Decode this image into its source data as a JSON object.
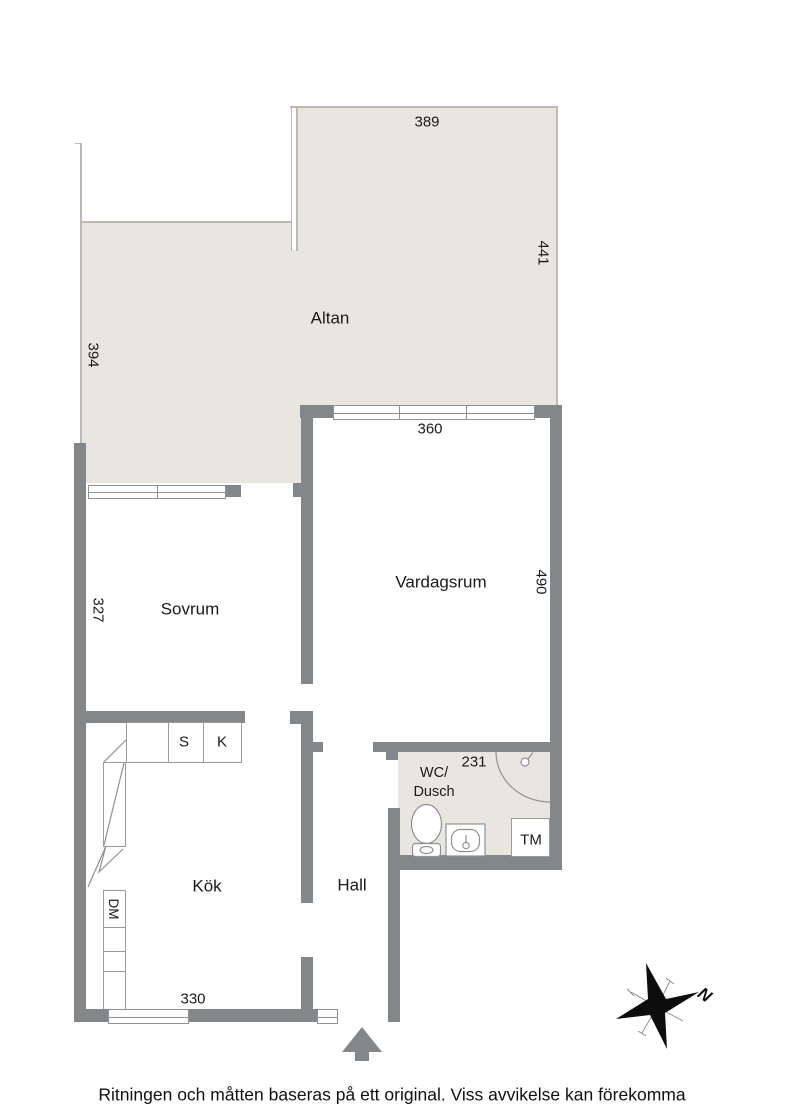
{
  "plan": {
    "rooms": {
      "altan": "Altan",
      "sovrum": "Sovrum",
      "vardagsrum": "Vardagsrum",
      "kok": "Kök",
      "hall": "Hall",
      "wc_line1": "WC/",
      "wc_line2": "Dusch"
    },
    "fixtures": {
      "tm": "TM",
      "dm": "DM",
      "s": "S",
      "k": "K"
    },
    "dimensions": {
      "altan_top": "389",
      "altan_right": "441",
      "altan_left": "394",
      "vardagsrum_top": "360",
      "vardagsrum_right": "490",
      "sovrum_left": "327",
      "wc": "231",
      "kok_bottom": "330"
    },
    "compass_north": "N"
  },
  "footer": {
    "disclaimer": "Ritningen och måtten baseras på ett original. Viss avvikelse kan förekomma"
  },
  "colors": {
    "wall": "#84878a",
    "outdoor_floor": "#e9e6df",
    "thin_outline": "#bcb9b2",
    "fixture_line": "#8f9193",
    "text": "#1a1a1a"
  }
}
